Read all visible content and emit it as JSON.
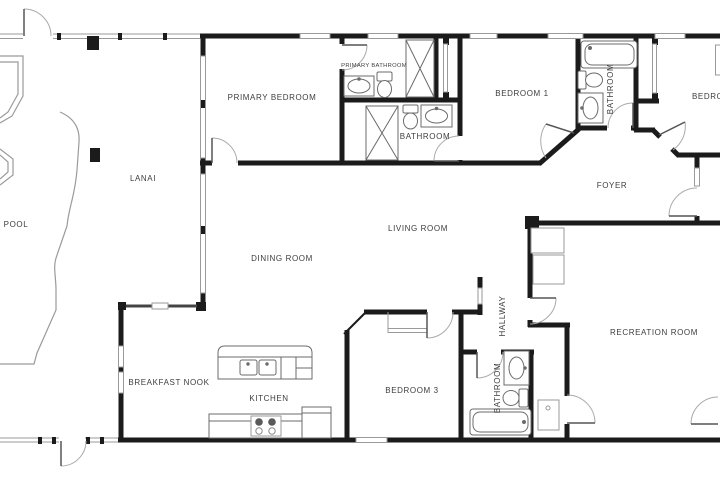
{
  "colors": {
    "wall": "#1b1b1b",
    "thin_line": "#9a9a9a",
    "fixture_line": "#6b6b6b",
    "label_text": "#3d3d3d",
    "background": "#ffffff"
  },
  "rooms": {
    "pool": {
      "label": "POOL"
    },
    "lanai": {
      "label": "LANAI"
    },
    "primary_bedroom": {
      "label": "PRIMARY BEDROOM"
    },
    "primary_bathroom": {
      "label": "PRIMARY BATHROOM"
    },
    "bathroom_2": {
      "label": "BATHROOM"
    },
    "bedroom_1": {
      "label": "BEDROOM 1"
    },
    "hall_bathroom": {
      "label": "BATHROOM"
    },
    "bedroom_2": {
      "label": "BEDROOM"
    },
    "foyer": {
      "label": "FOYER"
    },
    "living_room": {
      "label": "LIVING ROOM"
    },
    "dining_room": {
      "label": "DINING ROOM"
    },
    "breakfast_nook": {
      "label": "BREAKFAST NOOK"
    },
    "kitchen": {
      "label": "KITCHEN"
    },
    "bedroom_3": {
      "label": "BEDROOM 3"
    },
    "hallway": {
      "label": "HALLWAY"
    },
    "guest_bathroom": {
      "label": "BATHROOM"
    },
    "recreation_room": {
      "label": "RECREATION ROOM"
    }
  }
}
